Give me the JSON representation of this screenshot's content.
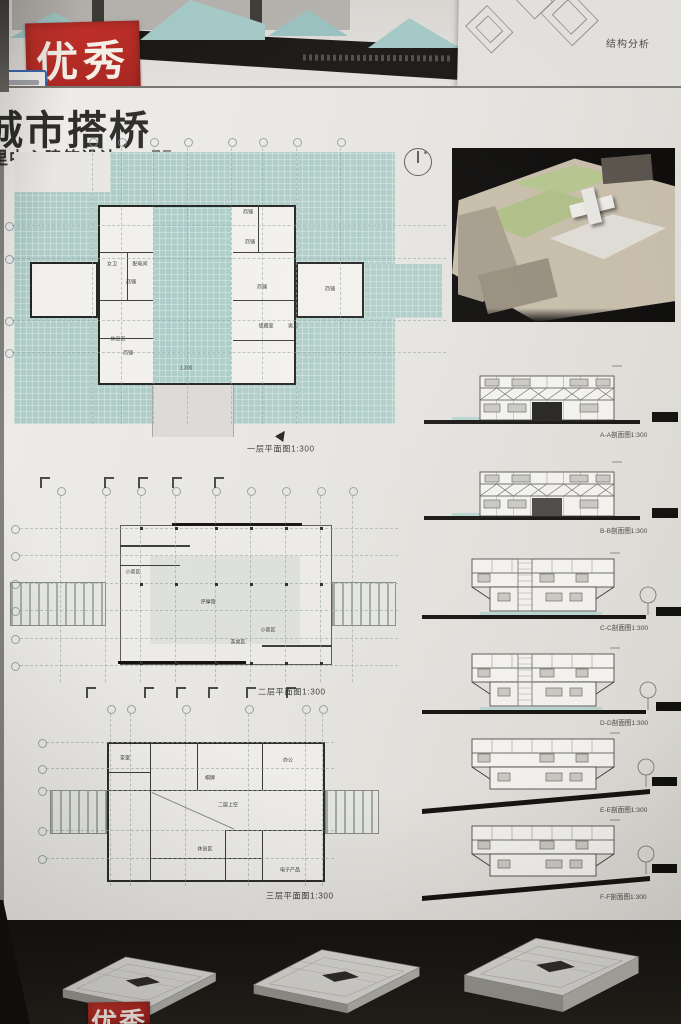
{
  "upper_board": {
    "award_stamp": "优秀",
    "structure_label": "结构分析"
  },
  "board": {
    "title": "城市搭桥",
    "subtitle": "里中心建筑设计",
    "plan1": {
      "caption": "一层平面图1:300",
      "level": "1.300",
      "rooms": [
        "商铺",
        "商铺",
        "商铺",
        "商铺",
        "商铺",
        "商铺",
        "休息区",
        "女卫",
        "配电间",
        "储藏室",
        "男卫"
      ]
    },
    "plan2": {
      "caption": "二层平面图1:300",
      "rooms": [
        "小卖区",
        "评弹馆",
        "小卖区",
        "茶桌区"
      ]
    },
    "plan3": {
      "caption": "三层平面图1:300",
      "rooms": [
        "茶室",
        "棋牌",
        "办公",
        "二层上空",
        "休息区",
        "电子产品"
      ]
    },
    "sections": [
      {
        "id": "A",
        "caption": "A-A剖面图1:300",
        "variant": "truss"
      },
      {
        "id": "B",
        "caption": "B-B剖面图1:300",
        "variant": "truss"
      },
      {
        "id": "C",
        "caption": "C-C剖面图1:300",
        "variant": "flare"
      },
      {
        "id": "D",
        "caption": "D-D剖面图1:300",
        "variant": "flare"
      },
      {
        "id": "E",
        "caption": "E-E剖面图1:300",
        "variant": "slope"
      },
      {
        "id": "F",
        "caption": "F-F剖面图1:300",
        "variant": "slope"
      }
    ],
    "bottom_stamp": "优秀"
  }
}
